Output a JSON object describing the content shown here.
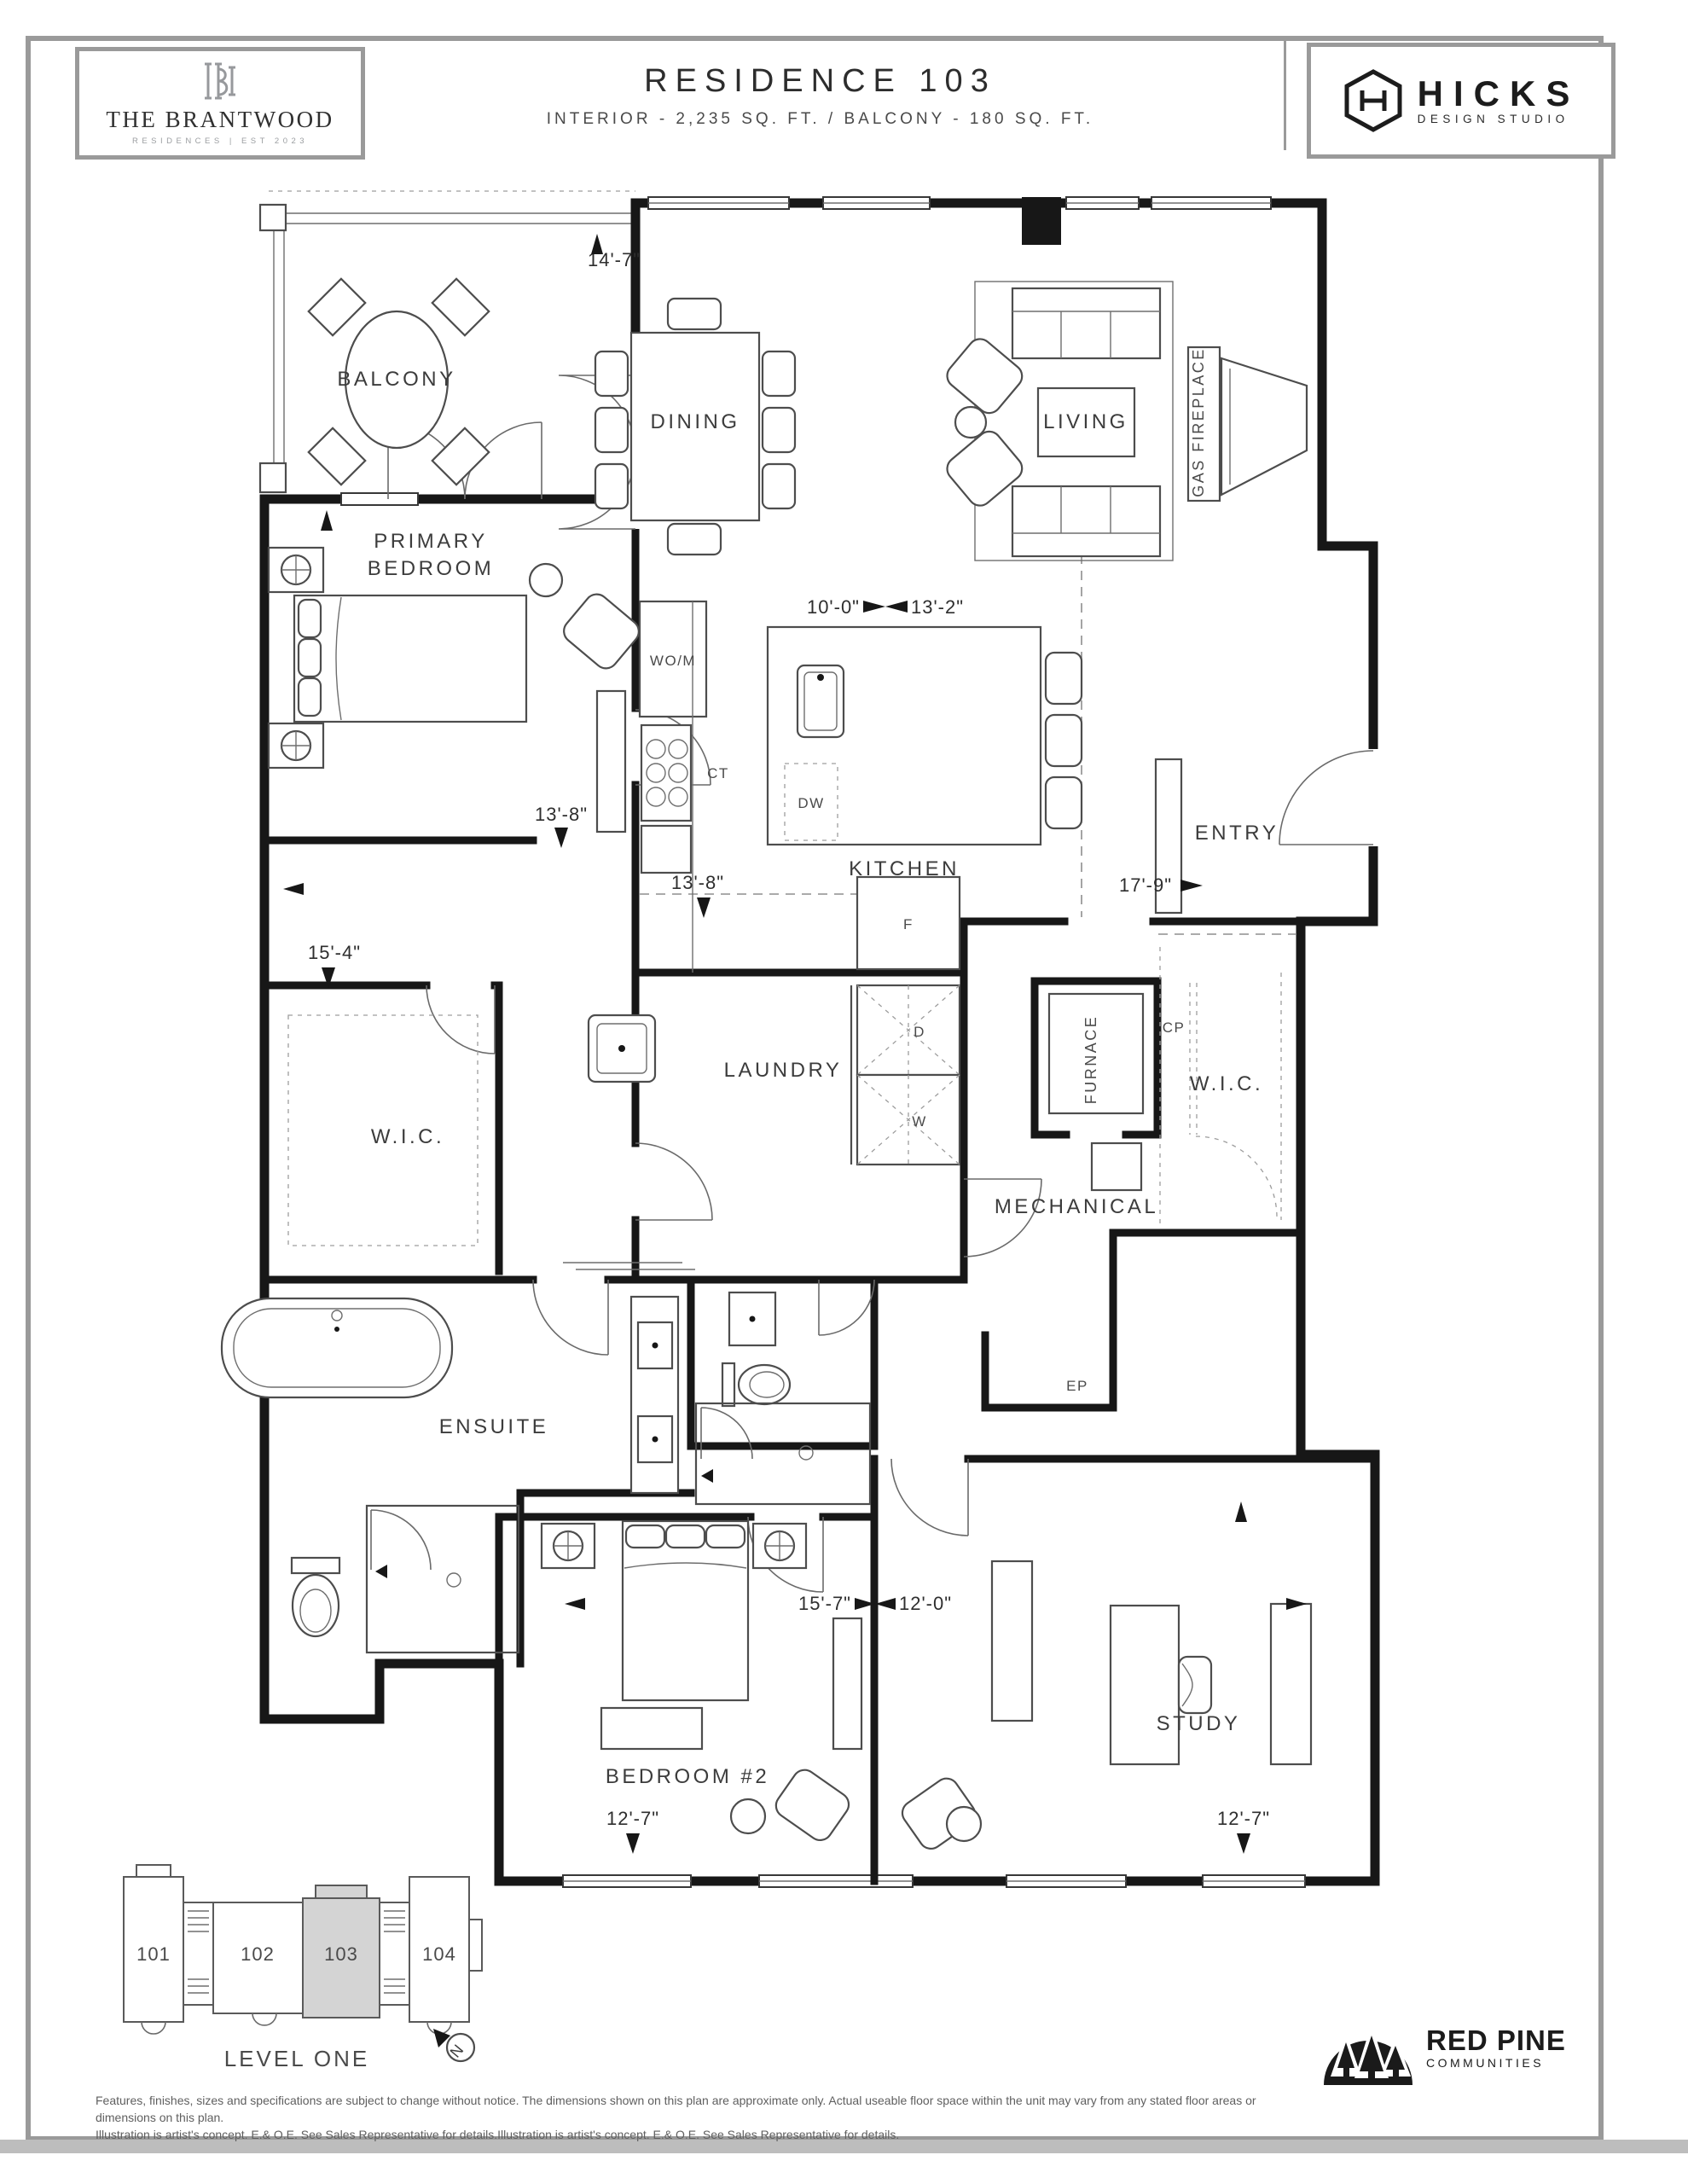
{
  "header": {
    "brand": {
      "name": "THE BRANTWOOD",
      "sub": "RESIDENCES | EST 2023"
    },
    "title": "RESIDENCE 103",
    "subtitle": "INTERIOR - 2,235 SQ. FT. / BALCONY - 180 SQ. FT.",
    "studio": {
      "name": "HICKS",
      "sub": "DESIGN STUDIO"
    }
  },
  "plan": {
    "rooms": {
      "balcony": "BALCONY",
      "dining": "DINING",
      "living": "LIVING",
      "gas_fireplace": "GAS FIREPLACE",
      "primary_line1": "PRIMARY",
      "primary_line2": "BEDROOM",
      "kitchen": "KITCHEN",
      "entry": "ENTRY",
      "laundry": "LAUNDRY",
      "wic_left": "W.I.C.",
      "wic_right": "W.I.C.",
      "furnace": "FURNACE",
      "mechanical": "MECHANICAL",
      "ensuite": "ENSUITE",
      "bedroom2": "BEDROOM #2",
      "study": "STUDY"
    },
    "labels": {
      "wom": "WO/M",
      "ct": "CT",
      "dw": "DW",
      "f": "F",
      "d": "D",
      "w": "W",
      "cp": "CP",
      "ep": "EP"
    },
    "dims": {
      "d14_7": "14'-7\"",
      "d10_0": "10'-0\"",
      "d13_2": "13'-2\"",
      "d13_8a": "13'-8\"",
      "d13_8b": "13'-8\"",
      "d17_9": "17'-9\"",
      "d15_4": "15'-4\"",
      "d15_7": "15'-7\"",
      "d12_0": "12'-0\"",
      "d12_7a": "12'-7\"",
      "d12_7b": "12'-7\""
    }
  },
  "keyplan": {
    "units": [
      "101",
      "102",
      "103",
      "104"
    ],
    "level": "LEVEL ONE",
    "north": "N"
  },
  "footer": {
    "disclaimer_line1": "Features, finishes, sizes and specifications are subject to change without notice. The dimensions shown on this plan are approximate only. Actual useable floor space within the unit may vary from any stated floor areas or dimensions on this plan.",
    "disclaimer_line2": "Illustration is artist's concept. E.& O.E. See Sales Representative for details.Illustration is artist's concept. E.& O.E. See Sales Representative for details.",
    "developer": {
      "name": "RED PINE",
      "sub": "COMMUNITIES"
    }
  }
}
